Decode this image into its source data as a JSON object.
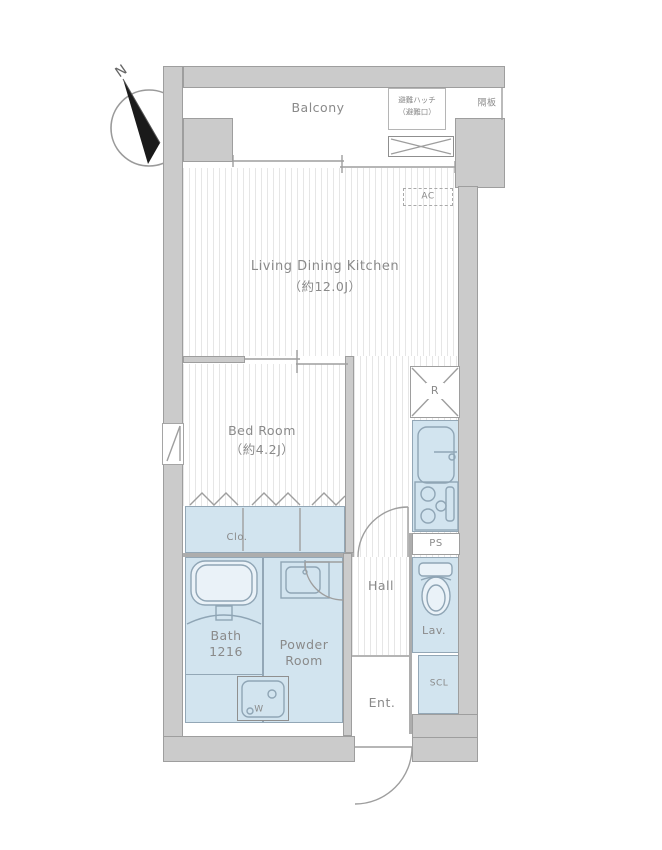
{
  "colors": {
    "wall": "#cbcbcb",
    "outline": "#9e9e9e",
    "room_blue": "#d2e4ef",
    "room_blue_outline": "#93a7b6",
    "fixture": "#8fa5b5",
    "text": "#8a8a8a",
    "hatch_line": "#e6e6e6",
    "needle": "#1a1a1a"
  },
  "compass": {
    "north": "N"
  },
  "balcony": {
    "label": "Balcony",
    "evac_hatch_line1": "避難ハッチ",
    "evac_hatch_line2": "（避難口）",
    "partition": "隔板"
  },
  "ldk": {
    "name": "Living Dining Kitchen",
    "size": "（約12.0J）",
    "ac": "AC"
  },
  "bedroom": {
    "name": "Bed Room",
    "size": "（約4.2J）"
  },
  "closet": {
    "label": "Clo."
  },
  "bath": {
    "name": "Bath",
    "size": "1216"
  },
  "powder_room": {
    "name_line1": "Powder",
    "name_line2": "Room",
    "washer": "W"
  },
  "hall": {
    "label": "Hall"
  },
  "entrance": {
    "label": "Ent."
  },
  "lavatory": {
    "label": "Lav."
  },
  "shoe_closet": {
    "label": "SCL"
  },
  "pipe_space": {
    "label": "PS"
  },
  "kitchen": {
    "refrigerator": "R"
  }
}
